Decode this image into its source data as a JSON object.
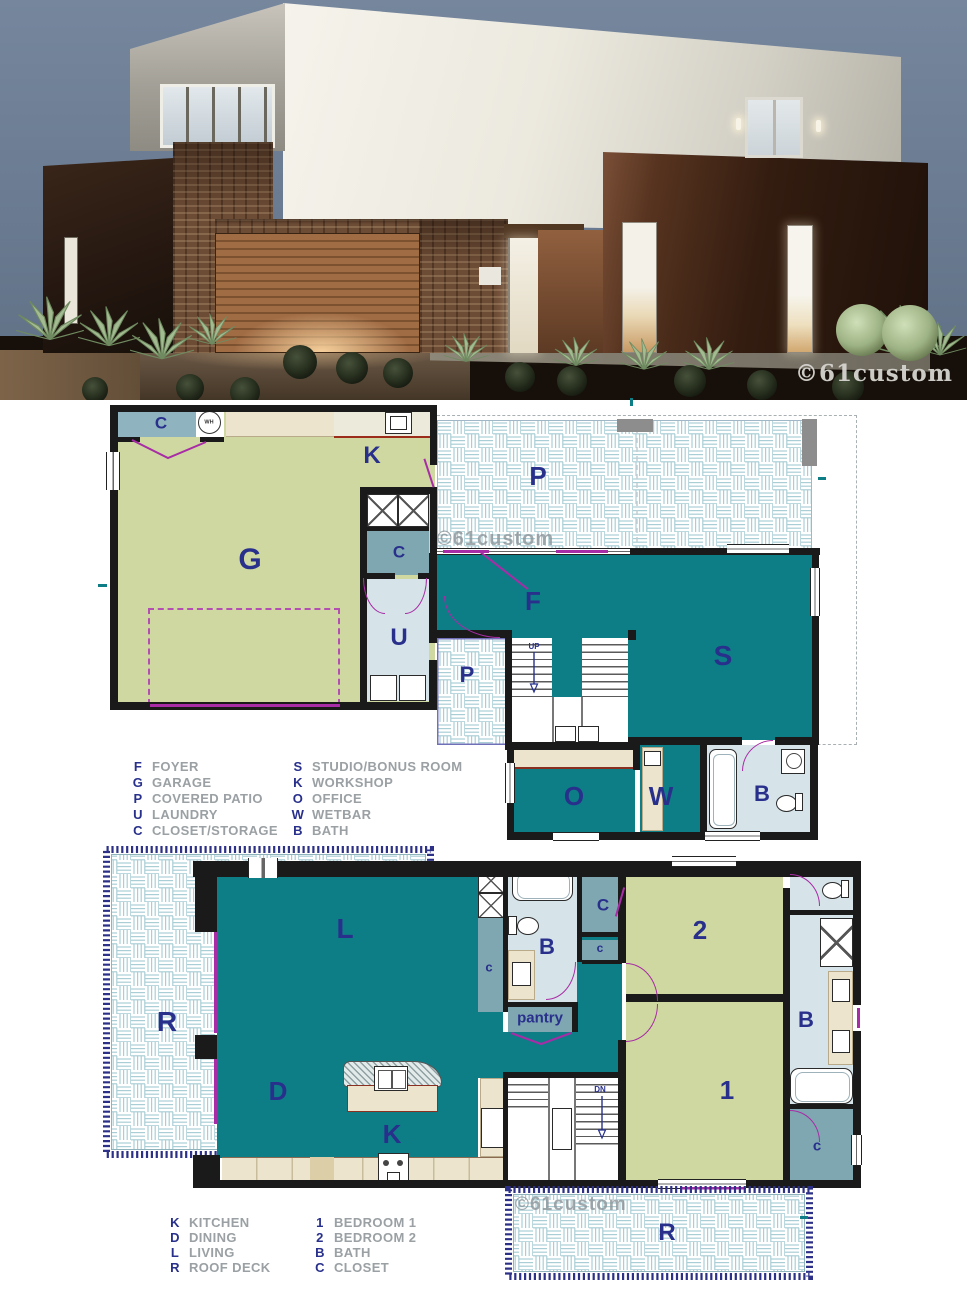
{
  "render": {
    "watermark": "©61custom"
  },
  "plan1": {
    "watermark": "©61custom",
    "labels": {
      "closet_top": "C",
      "wh": "WH",
      "workshop": "K",
      "garage": "G",
      "closet_mid": "C",
      "laundry": "U",
      "patio_main": "P",
      "foyer": "F",
      "patio_entry": "P",
      "studio": "S",
      "up": "UP",
      "office": "O",
      "wetbar": "W",
      "bath": "B"
    },
    "legend": {
      "col1": [
        {
          "key": "F",
          "label": "FOYER"
        },
        {
          "key": "G",
          "label": "GARAGE"
        },
        {
          "key": "P",
          "label": "COVERED PATIO"
        },
        {
          "key": "U",
          "label": "LAUNDRY"
        },
        {
          "key": "C",
          "label": "CLOSET/STORAGE"
        }
      ],
      "col2": [
        {
          "key": "S",
          "label": "STUDIO/BONUS ROOM"
        },
        {
          "key": "K",
          "label": "WORKSHOP"
        },
        {
          "key": "O",
          "label": "OFFICE"
        },
        {
          "key": "W",
          "label": "WETBAR"
        },
        {
          "key": "B",
          "label": "BATH"
        }
      ]
    }
  },
  "plan2": {
    "watermark": "©61custom",
    "labels": {
      "living": "L",
      "roof_deck": "R",
      "closet_left": "c",
      "bath_top": "B",
      "closet_top": "C",
      "closet_small": "c",
      "pantry": "pantry",
      "bedroom2": "2",
      "bedroom1": "1",
      "bath_right": "B",
      "closet_bottom": "c",
      "dining": "D",
      "kitchen": "K",
      "down": "DN",
      "roof_deck_bottom": "R"
    },
    "legend": {
      "col1": [
        {
          "key": "K",
          "label": "KITCHEN"
        },
        {
          "key": "D",
          "label": "DINING"
        },
        {
          "key": "L",
          "label": "LIVING"
        },
        {
          "key": "R",
          "label": "ROOF DECK"
        }
      ],
      "col2": [
        {
          "key": "1",
          "label": "BEDROOM 1"
        },
        {
          "key": "2",
          "label": "BEDROOM 2"
        },
        {
          "key": "B",
          "label": "BATH"
        },
        {
          "key": "C",
          "label": "CLOSET"
        }
      ]
    }
  },
  "colors": {
    "teal": "#0d7d86",
    "green": "#cfd8a0",
    "pale_blue": "#d6e3e9",
    "blue_gray": "#7fa7b1",
    "tan": "#ece4cc",
    "magenta": "#a82ca6",
    "navy_label": "#28308c",
    "tile_border": "#2c3086"
  }
}
